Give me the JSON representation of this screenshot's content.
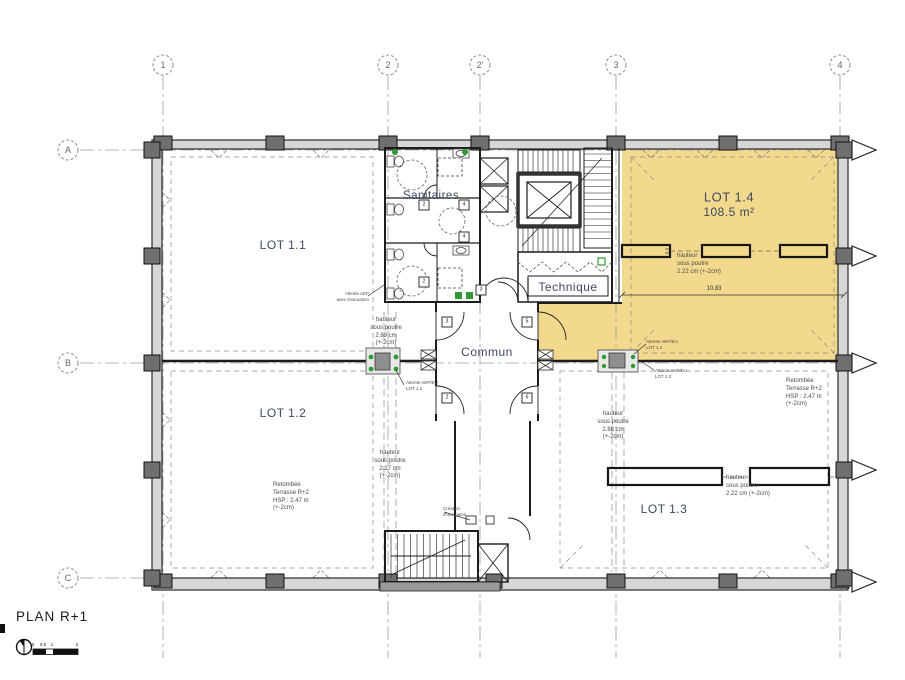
{
  "plan": {
    "title": "PLAN R+1",
    "scale_ticks": [
      "0",
      "0.5",
      "1",
      "2"
    ]
  },
  "grid": {
    "cols": [
      {
        "label": "1"
      },
      {
        "label": "2"
      },
      {
        "label": "2'"
      },
      {
        "label": "3"
      },
      {
        "label": "4"
      }
    ],
    "rows": [
      {
        "label": "A"
      },
      {
        "label": "B"
      },
      {
        "label": "C"
      }
    ]
  },
  "rooms": {
    "lot11": {
      "label": "LOT 1.1"
    },
    "lot12": {
      "label": "LOT 1.2"
    },
    "lot13": {
      "label": "LOT 1.3"
    },
    "lot14": {
      "label": "LOT 1.4",
      "area": "108.5 m²"
    },
    "sanitaires": {
      "label": "Sanitaires"
    },
    "technique": {
      "label": "Technique"
    },
    "commun": {
      "label": "Commun"
    }
  },
  "annotations": {
    "hsp_lot14": "hauteur\nsous poutre\n2.22 cm (+-2cm)",
    "hsp_289": "hauteur\nsous poutre\n2.89 cm\n(+-2cm)",
    "attente_aep": "Attente AEP\navec évacuation",
    "hsp_227_mid": "hauteur\nsous poutre\n2.27 cm\n(+-2cm)",
    "retombee_left": "Retombée\nTerrasse R+2\nHSP : 2.47 m\n(+-2cm)",
    "hsp_288": "hauteur\nsous poutre\n2.88 cm\n(+-2cm)",
    "retombee_right": "Retombée\nTerrasse R+2\nHSP : 2.47 m\n(+-2cm)",
    "hsp_222_lot13": "hauteur\nsous poutre\n2.22 cm (+-2cm)",
    "attente_lot14": "Attente AEP/EU\nLOT 1.4",
    "attente_lot13": "Attente AEP/EU\nLOT 1.3",
    "attente_lot12": "Attente AEP/EU\nLOT 1.2",
    "creation_gaine": "Création\nd'une gaine"
  },
  "dimensions": {
    "d1": "10.83",
    "d2": "0.3"
  },
  "door_tags": [
    "3",
    "3",
    "5",
    "2",
    "6",
    "2",
    "4",
    "4",
    "2"
  ],
  "colors": {
    "lot14_highlight": "#F2D98D",
    "fixture_green": "#2F9A33",
    "label_text": "#3E4A5F"
  }
}
